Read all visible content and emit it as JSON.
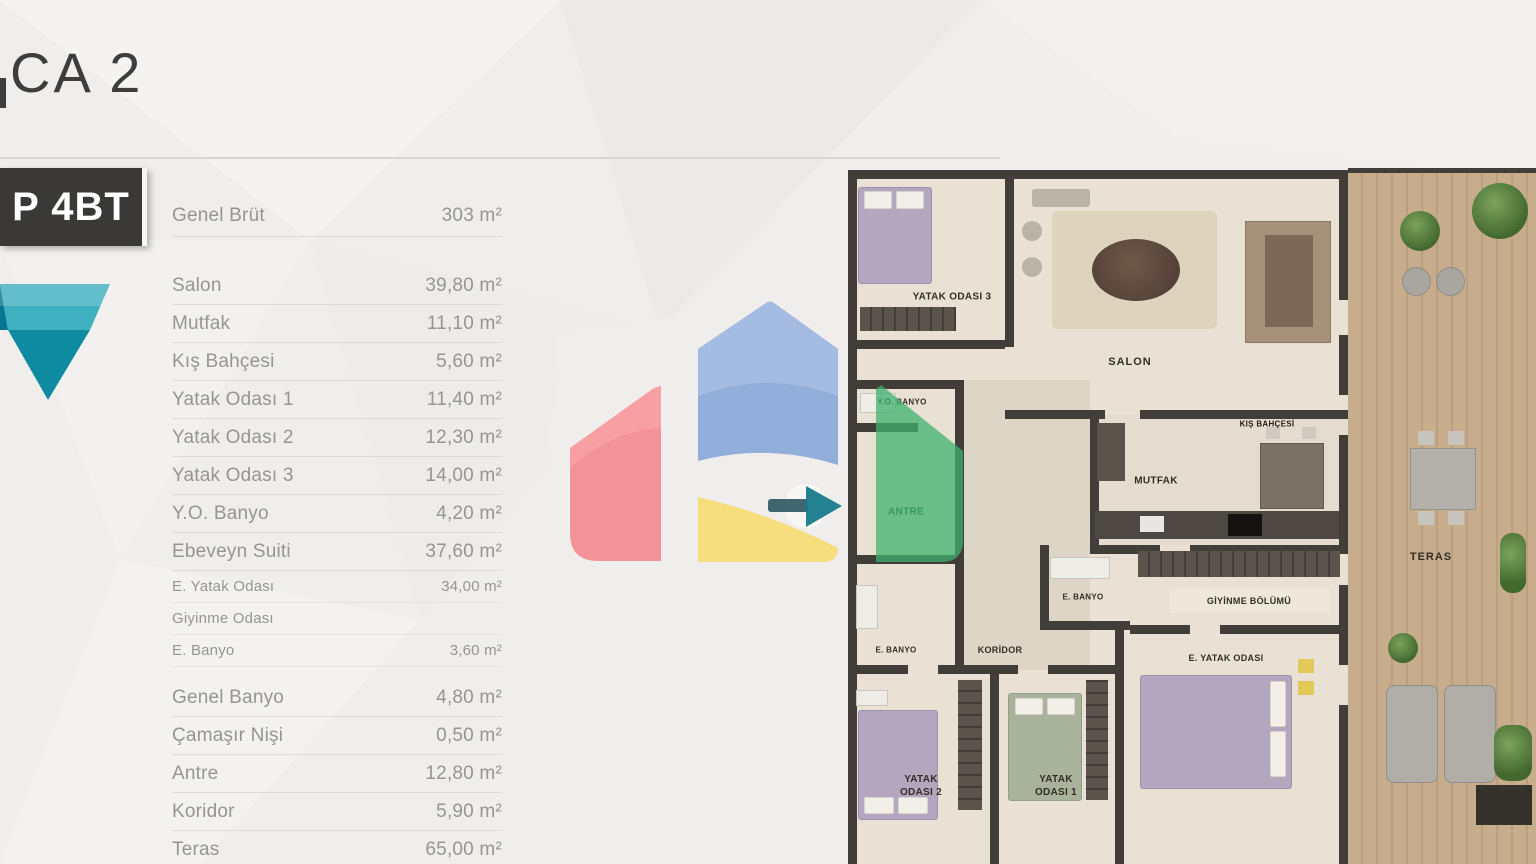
{
  "page": {
    "title": "CA 2",
    "type_badge": "P 4BT"
  },
  "area_table": {
    "rows": [
      {
        "label": "Genel Brüt",
        "value": "303 m²",
        "style": "header"
      },
      {
        "label": "Salon",
        "value": "39,80 m²",
        "style": "main"
      },
      {
        "label": "Mutfak",
        "value": "11,10 m²",
        "style": "main"
      },
      {
        "label": "Kış Bahçesi",
        "value": "5,60 m²",
        "style": "main"
      },
      {
        "label": "Yatak Odası 1",
        "value": "11,40 m²",
        "style": "main"
      },
      {
        "label": "Yatak Odası 2",
        "value": "12,30 m²",
        "style": "main"
      },
      {
        "label": "Yatak Odası 3",
        "value": "14,00 m²",
        "style": "main"
      },
      {
        "label": "Y.O. Banyo",
        "value": "4,20 m²",
        "style": "main"
      },
      {
        "label": "Ebeveyn Suiti",
        "value": "37,60 m²",
        "style": "main"
      },
      {
        "label": "E. Yatak Odası",
        "value": "34,00 m²",
        "style": "sub"
      },
      {
        "label": "Giyinme Odası",
        "value": "",
        "style": "sub"
      },
      {
        "label": "E. Banyo",
        "value": "3,60 m²",
        "style": "sub"
      },
      {
        "label": "Genel Banyo",
        "value": "4,80 m²",
        "style": "main"
      },
      {
        "label": "Çamaşır Nişi",
        "value": "0,50 m²",
        "style": "main"
      },
      {
        "label": "Antre",
        "value": "12,80 m²",
        "style": "main"
      },
      {
        "label": "Koridor",
        "value": "5,90 m²",
        "style": "main"
      },
      {
        "label": "Teras",
        "value": "65,00 m²",
        "style": "main"
      }
    ]
  },
  "floor_plan": {
    "rooms": {
      "yatak_odasi_3": "YATAK ODASI 3",
      "salon": "SALON",
      "kis_bahcesi": "KIŞ BAHÇESİ",
      "mutfak": "MUTFAK",
      "yo_banyo": "Y.O. BANYO",
      "antre": "ANTRE",
      "e_banyo_orta": "E. BANYO",
      "giyinme_bolumu": "GİYİNME BÖLÜMÜ",
      "e_yatak_odasi": "E. YATAK ODASI",
      "e_banyo_sol": "E. BANYO",
      "koridor": "KORİDOR",
      "yatak_odasi_2": "YATAK ODASI 2",
      "yatak_odasi_1": "YATAK ODASI 1",
      "teras": "TERAS"
    }
  },
  "watermark": {
    "colors": {
      "red": "#f5868b",
      "red_light": "#f9a7aa",
      "blue": "#8aa8d8",
      "blue_light": "#a9c0e4",
      "yellow": "#f6db74",
      "green": "#3db06d",
      "arrow_teal": "#177a8c",
      "arrow_dark": "#2b5563"
    }
  },
  "brand": {
    "badge_bg": "#3a3937",
    "diamond_teal_light": "#3fb0bf",
    "diamond_teal_dark": "#0e8ba0"
  }
}
